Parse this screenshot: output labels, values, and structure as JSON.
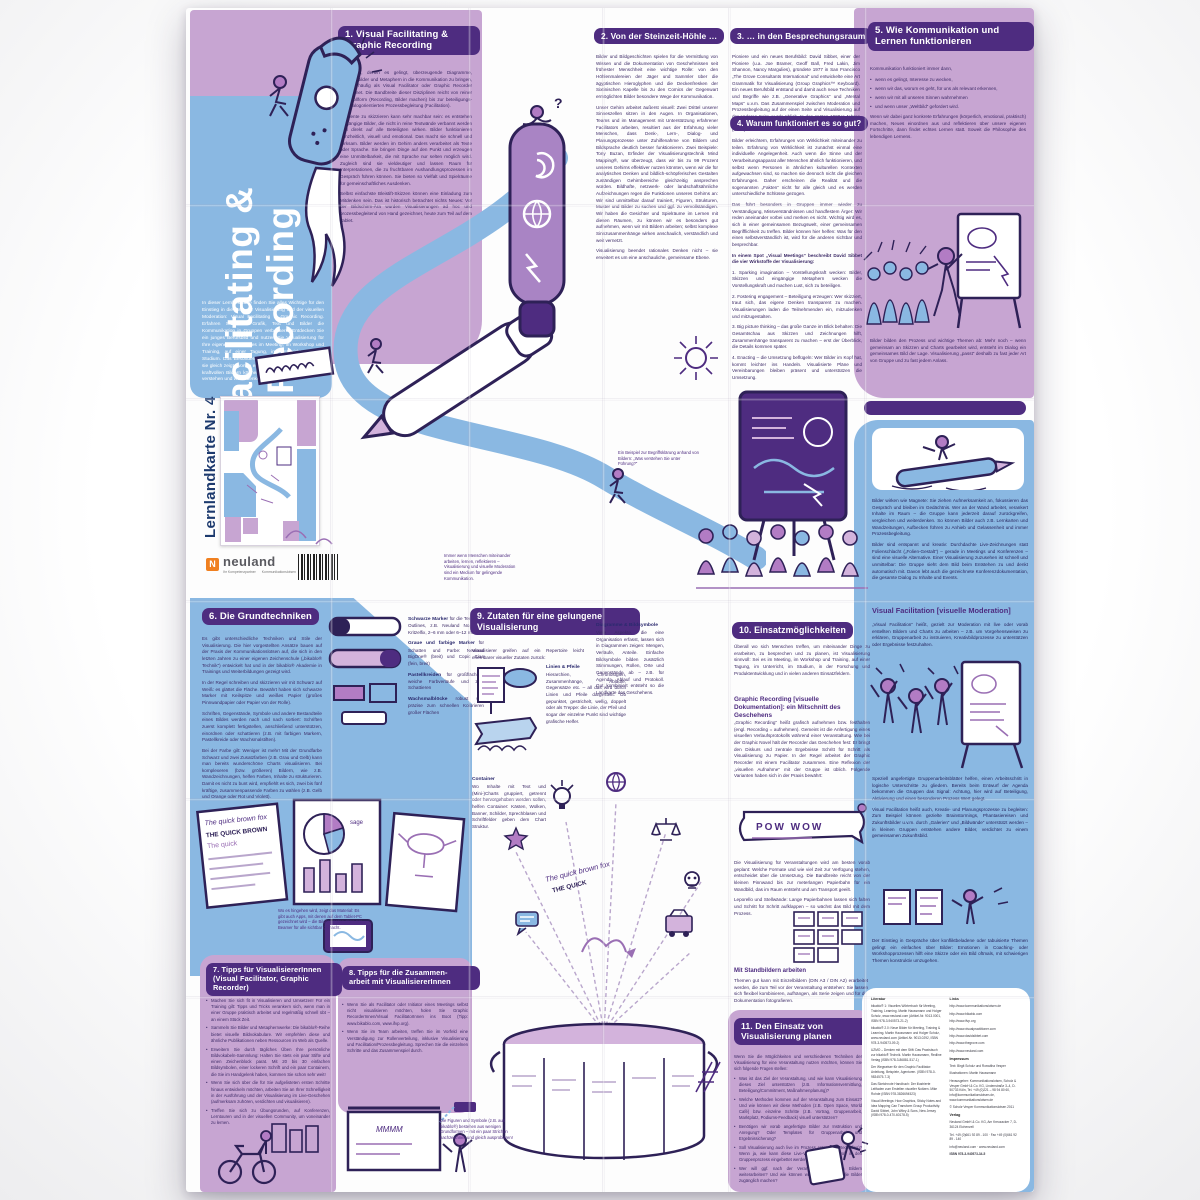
{
  "masthead": {
    "series": "Lernlandkarte Nr. 4",
    "title_line1": "Visual Facilitating &",
    "title_line2": "Graphic Recording",
    "intro": "In dieser Lernlandkarte finden Sie alles Wichtige für den Einstieg in die Welt der Visualisierung und der visuellen Moderation: Visual Facilitating & Graphic Recording. Erfahren Sie, wie Grafik, Text und Bilder die Kommunikation in Gruppen verbessern. Entdecken Sie ein junges Berufsbild und nutzen Sie Visualisierung für Ihre eigene Arbeit: sei es im Meeting, im Workshop und Training, auf einer Tagung, im Unterricht oder im Studium. Das Besondere dieser Lernlandkarte ist, dass sie gleich zeigt, worum es geht: Mit wenigen Worten und kraftvollen Bildern können Sie Inhalte schnell erfassen, verstehen und weiterdenken."
  },
  "captions": {
    "begriff": "Ein Beispiel zur Begriffsklärung anhand von Bildern: „Was verstehen Sie unter Führung?“",
    "medium": "Immer wenn Menschen miteinander arbeiten, lernen, reflektieren – Visualisierung und visuelle Moderation sind ein Medium für gelingende Kommunikation.",
    "figuren": "Die Figuren und Symbole (z.B. aus bikablo®) bestehen aus wenigen Grundformen – mit ein paar Strichen nachzeichnen und gleich ausprobieren!"
  },
  "s1": {
    "h1": "1. Visual Facilitating &",
    "h2": "Graphic Recording",
    "p": [
      "Menschen, denen es gelingt, überzeugende Diagramme, Farben, Bilder und Metaphern in die Kommunikation zu bringen, werden häufig als Visual Facilitator oder Graphic Recorder bezeichnet. Die Bandbreite dieser Disziplinen reicht von reiner Protokollform (Recording, Bilder machen) bis zur beteiligungs- und dialogorientierten Prozessbegleitung (Facilitation).",
      "Elemente zu skizzieren kann sehr machbar sein: es entstehen eingängige Bilder, die nicht in reine Textwände verbannt werden und direkt auf alle Beteiligten wirken. Bilder funktionieren ganzheitlich, visuell und emotional. Das macht sie schnell und wirksam. Bilder werden im Gehirn anders verarbeitet als Texte oder Sprache. Sie bringen Dinge auf den Punkt und erzeugen eine Unmittelbarkeit, die mit Sprache nur selten möglich wird. Zugleich sind sie vieldeutiger und lassen Raum für Interpretationen, die zu fruchtbaren Aushandlungsprozessen im Gespräch führen können. Sie bieten so Vielfalt und Spielräume für gemeinschaftliches Ausdenken.",
      "Selbst einfachste Bleistift-Skizzen können eine Einladung zum Mitdenken sein. Das ist historisch betrachtet nichts Neues: Vor der Bildschirm-Ära wurden Visualisierungen ad hoc und prozessbegleitend von Hand gezeichnet, heute zum Teil auf dem Tablet."
    ]
  },
  "s2": {
    "h": "2. Von der Steinzeit-Höhle …",
    "p": [
      "Bilder und Bildgeschichten spielen für die Vermittlung von Wissen und die Dokumentation von Geschehnissen seit frühester Menschheit eine wichtige Rolle: von den Höhlenmalereien der Jäger und Sammler über die ägyptischen Hieroglyphen und die Deckenfresken der Sixtinischen Kapelle bis zu den Comics der Gegenwart ermöglichten Bilder besondere Wege der Kommunikation.",
      "Unser Gehirn arbeitet äußerst visuell: Zwei Drittel unserer Sinneszellen sitzen in den Augen. In Organisationen, Teams und im Management mit Unterstützung erfahrener Facilitators arbeiten, resultiert aus der Erfahrung vieler Menschen, dass Denk-, Lern-, Dialog- und Planungsprozesse unter Zuhilfenahme von Bildern und Bildsprache deutlich besser funktionieren. Zwei Beispiele: Tony Buzan, Erfinder der Visualisierungstechnik Mind Mapping®, war überzeugt, dass wir bis zu 99 Prozent unseres Gehirns effektiver nutzen könnten, wenn wir die für analytisches Denken und bildlich-schöpferisches Gestalten zuständigen Gehirnbereiche gleichzeitig ansprechen würden. Bildhafte, netzwerk- oder landschaftsähnliche Aufzeichnungen regen die Funktionen unseres Gehirns an: Wir sind unmittelbar darauf trainiert, Figuren, Strukturen, Muster und Bilder zu suchen und ggf. zu vervollständigen. Wir haben die Gesichter und Spielräume im Lernen mit diesen Räumen, zu können wir es besonders gut aufnehmen, wenn wir mit Bildern arbeiten; selbst komplexe Sinnzusammenhänge wirken anschaulich, verständlich und weit vernetzt.",
      "Visualisierung beendet rationales Denken nicht – sie erweitert es um eine anschauliche, gemeinsame Ebene."
    ]
  },
  "s3": {
    "h": "3. … in den Besprechungsraum",
    "p": [
      "Pioniere und ein neues Berufsbild: David Sibbet, einer der Pioniere (u.a. Joe Bramer, Geoff Ball, Fred Lakin, Jim Shannon, Nancy Margulies), gründete 1977 in San Francisco „The Grove Consultants International“ und entwickelte eine Art Grammatik für Visualisierung (Group Graphics™ Keyboard). Ein neues Berufsbild entstand und damit auch neue Techniken und Begriffe wie z.B. „Generative Graphics“ und „Mental Maps“ u.v.m. Das Zusammenspiel zwischen Moderation und Prozessbegleitung auf der einen Seite und Visualisierung auf der anderen Seite wurde üblich. In den späten 1990er-Jahren gründete sich das „International Forum of Visual Practitioners“ (IFVP)."
    ]
  },
  "s4": {
    "h": "4. Warum funktioniert es so gut?",
    "p1": "Bilder erleichtern, Erfahrungen von Wirklichkeit miteinander zu teilen. Erfahrung von Wirklichkeit ist zunächst einmal eine individuelle Angelegenheit. Auch wenn die Sinne und der Verarbeitungsapparat aller Menschen ähnlich funktionieren, und selbst wenn Personen in ähnlichen kulturellen Kontexten aufgewachsen sind, so machen sie dennoch nicht die gleichen Erfahrungen. Daher erscheinen die Realität und die sogenannten „Fakten“ nicht für alle gleich und es werden unterschiedliche Schlüsse gezogen.",
    "p2": "Das führt besonders in Gruppen immer wieder zu Verständigung, Missverständnissen und handfestem Ärger: Wir reden aneinander vorbei und merken es nicht. Wichtig wird es, sich in einer gemeinsamen Bezugswelt, einer gemeinsamen Begrifflichkeit zu treffen. Bilder können hier helfen: Was für den einen selbstverständlich ist, wird für die anderen sichtbar und besprechbar.",
    "lead": "In einem Spot „Visual Meetings“ beschreibt David Sibbet die vier Wirkstoffe der Visualisierung:",
    "items": [
      "1. Sparking imagination – Vorstellungskraft wecken: Bilder, Skizzen und eingängige Metaphern wecken die Vorstellungskraft und machen Lust, sich zu beteiligen.",
      "2. Fostering engagement – Beteiligung erzeugen: Wer skizziert, traut sich, das eigene Denken transparent zu machen. Visualisierungen laden die Teilnehmenden ein, mitzudenken und mitzugestalten.",
      "3. Big picture thinking – das große Ganze im Blick behalten: Die Gesamtschau aus Skizzen und Zeichnungen hilft, Zusammenhänge transparent zu machen – erst der Überblick, die Details kommen später.",
      "4. Enacting – die Umsetzung beflügeln: Wer Bilder im Kopf hat, kommt leichter ins Handeln. Visualisierte Pläne und Vereinbarungen bleiben präsent und unterstützen die Umsetzung."
    ]
  },
  "s5": {
    "h1": "5. Wie Kommunikation und",
    "h2": "Lernen funktionieren",
    "lead": "Kommunikation funktioniert immer dann,",
    "bullets": [
      "wenn es gelingt, Interesse zu wecken,",
      "wenn wir das, worum es geht, für uns als relevant erkennen,",
      "wenn wir mit all unseren Sinnen wahrnehmen",
      "und wenn unser „Weltbild“ gefordert wird."
    ],
    "p2": "Wenn wir dabei ganz konkrete Erfahrungen (körperlich, emotional, praktisch) machen, Neues einordnen aus und reflektieren über unsere eigenen Fortschritte, dann findet echtes Lernen statt. Soweit die Philosophie des lebendigen Lernens.",
    "p3": "Bilder bilden den Prozess und wichtige Themen ab: Mehr noch – wenn gemeinsam an Skizzen und Charts gearbeitet wird, entsteht im Dialog ein gemeinsames Bild der Lage. Visualisierung „passt“ deshalb zu fast jeder Art von Gruppe und zu fast jedem Anlass.",
    "p4": "Bilder wirken wie Magnete: Sie ziehen Aufmerksamkeit an, fokussieren das Gespräch und bleiben im Gedächtnis. Wer an der Wand arbeitet, verankert Inhalte im Raum – die Gruppe kann jederzeit darauf zurückgreifen, vergleichen und weiterdenken. So können Bilder auch z.B. Lernkarten und Wandzeitungen, Aufbecken führen zu Anhieb und Gelassenheit und immer Prozessbegleitung.",
    "p5": "Bilder sind entspannt und kreativ: Durchdachte Live-Zeichnungen statt Folienschlacht („Folien-Gestalt“) – gerade in Meetings und Konferenzen – sind eine visuelle Alternative. Einer Visualisierung zuzusehen ist schnell und unmittelbar: Die Gruppe sieht dem Bild beim Entstehen zu und denkt automatisch mit. Davon lebt auch die gezeichnete Konferenz­dokumentation, die gesamte Dialog zu Inhalte und Events."
  },
  "vf": {
    "h": "Visual Facilitation [visuelle Moderation]",
    "p1": "„Visual Facilitation“ heißt, gezielt zur Moderation mit live oder vorab erstellten Bildern und Charts zu arbeiten – z.B. um Vorgehensweisen zu erklären, Gruppenarbeit zu instruieren, Kreativbildprozesse zu unterstützen oder Ergebnisse festzuhalten.",
    "p2": "Speziell angefertigte Gruppenarbeitsblätter helfen, einen Arbeitsschritt in logische Unterschritte zu gliedern. Bereits beim Entwurf der Agenda bekommen die Gruppen das Signal: Achtung, hier wird auf Beteiligung, Aktivierung und einen besonderen Prozess Wert gelegt.",
    "p3": "Visual Facilitation heißt auch, Kreativ- und Planungsprozesse zu begleiten: Zum Beispiel können gezielte Brainstormings, Phantasiereisen und Zukunftsbilder u.v.m. durch „Galerien“ und „Bildwände“ unterstützt werden – in kleinen Gruppen entstehen andere Bilder, verdichtet zu einem gemeinsamen Zukunftsbild.",
    "p4": "Der Einstieg in Gespräche über konfliktbeladene oder tabuisierte Themen gelingt ein einfaches über Bilder: Emotionen in Coaching- oder Workshopprozessen hilft eine Skizze oder ein Bild oftmals, mit schwierigen Themen konstruktiv umzugehen."
  },
  "s6": {
    "h": "6. Die Grundtechniken",
    "p": [
      "Es gibt unterschiedliche Techniken und Stile der Visualisierung. Die hier vorgestellten Ansätze bauen auf der Praxis der Kommunikationslotsen auf, die sich in den letzten Jahren zu einer eigenen Zeichenschule („bikablo® Technik“) entwickelt hat und in der bikablo® Akademie in Trainings und Weiterbildungen gezeigt wird.",
      "In der Regel schreiben und skizzieren wir mit Schwarz auf Weiß: es glättet die Fläche. Bewährt haben sich schwarze Marker mit Keilspitze und weißes Papier (großes Pinnwandpapier oder Papier von der Rolle).",
      "Schriften, Gegenstände, Symbole und andere Bestandteile eines Bildes werden nach und nach sortiert: Schriften zuerst komplett fertigstellen, anschließend unterstützen, einordnen oder schattieren (z.B. mit farbigen Markern, Pastellkreide oder Wachsmalstiften).",
      "Bei der Farbe gilt: Weniger ist mehr! Mit der Grundfarbe Schwarz und zwei Zusatzfarben (z.B. Grau und Gelb) kann man bereits wunderschöne Charts visualisieren. Bei komplexeren (bzw. größeren) Bildern, wie z.B. Wandzeichnungen, helfen Farben, Inhalte zu strukturieren. Damit es nicht zu bunt wird, empfiehlt es sich, zwei bis fünf kräftige, zusammenpassende Farben zu wählen (z.B. Gelb und Orange oder Rot und Violett)."
    ],
    "supplies": [
      {
        "label": "Schwarze Marker",
        "desc": "für die Texte und Outlines, z.B. Neuland No.One®, Kritzelfix, 2–6 mm oder 6–12 mm"
      },
      {
        "label": "Graue und farbige Marker",
        "desc": "für Schatten und Farbe: Neuland BigOne® (breit) und Copic Ciao (fein, breit)"
      },
      {
        "label": "Pastellkreiden",
        "desc": "für großflächige, weiche Farbverläufe und zum Schattieren"
      },
      {
        "label": "Wachsmalblöcke",
        "desc": "robust und präzise zum schnellen Kolorieren großer Flächen"
      }
    ],
    "caption": "Wo es hingehen wird, zeigt das Material: Es gibt auch Apps, mit denen auf dem Tablet-PC gezeichnet wird – die Bilder werden dann per Beamer für alle sichtbar gemacht.",
    "practice1": "The quick brown fox",
    "practice2": "THE QUICK BROWN FOX"
  },
  "s7": {
    "h": "7. Tipps für VisualisiererInnen",
    "sub": "(Visual Facilitator, Graphic Recorder)",
    "bullets": [
      "Machen Sie sich fit in Visualisieren und Umsetzen! Für ein Training gilt: Tipps und Tricks verankern sich, wenn man in einer Gruppe praktisch arbeitet und regelmäßig schnell übt – an einem Stück Zeit.",
      "Sammeln Sie Bilder und Metaphernwerke: Die bikablo®-Reihe bietet visuelle Bildvokabulare. Wir empfehlen diese und ähnliche Publikationen neben Ressourcen im Web als Quelle.",
      "Erweitern Sie durch tägliches Üben Ihre persönliche Bildvokabeln-Sammlung: Halten Sie stets ein paar Stifte und einen Zeichenblock parat. Mit 20 bis 30 einfachen Bildsymbolen, einer lockeren Schrift und ein paar Containern, die Sie im Handgelenk haben, kommen Sie schon sehr weit!",
      "Wenn Sie sich über die für Sie aufgelisteten ersten Schritte hinaus entwickeln möchten, arbeiten Sie an Ihrer Schnelligkeit in der Ausführung und der Visualisierung im Live-Geschehen (aufmerksam zuhören, verdichten und visualisieren).",
      "Treffen Sie sich zu Übungsrunden, auf Konferenzen, Lerntouren und in der visuellen Community, um voneinander zu lernen."
    ]
  },
  "s8": {
    "h1": "8. Tipps für die Zusammen-",
    "h2": "arbeit mit VisualisiererInnen",
    "bullets": [
      "Wenn Sie als Facilitator oder Initiator eines Meetings selbst nicht visualisieren möchten, holen Sie Graphic RecorderInnen/Visual FacilitatorInnen ins Boot (Tipp: www.bikablo.com, www.ifvp.org).",
      "Wenn Sie im Team arbeiten, treffen Sie im Vorfeld eine Verständigung zur Rollenverteilung, inklusive Visualisierung und Facilitation/Prozessbegleitung. Sprechen Sie die einzelnen Schritte und das Zusammenspiel durch."
    ]
  },
  "s9": {
    "h1": "9. Zutaten für eine gelungene",
    "h2": "Visualisierung",
    "intro": "Visualisierer greifen auf ein Repertoire leicht erlernbarer visueller Zutaten zurück:",
    "items": [
      {
        "label": "Linien & Pfeile",
        "desc": "Hierarchien, Chronologien, Zusammenhänge, Abläufe, Gegensätze etc. – all das wird durch Linien und Pfeile dargestellt. Ob gepunktet, gestrichelt, wellig, doppelt oder als Treppe: die Linie, der Pfeil und sogar der einzelne Punkt sind wichtige grafische Helfer."
      },
      {
        "label": "Container",
        "desc": "Wo Inhalte mit Text und (Mini-)Charts gruppiert, getrennt oder hervorgehoben werden sollen, helfen Container: Kästen, Wolken, Banner, Schilder, Sprechblasen und Schriftfelder geben dem Chart Struktur."
      },
      {
        "label": "Diagramme & Bildsymbole",
        "desc": "Viele Aspekte, die eine Organisation erfasst, lassen sich in Diagrammen zeigen: Mengen, Verläufe, Anteile. Einfache Bildsymbole bilden zusätzlich Stimmungen, Rollen, Orte und Gegenstände ab – z.B. für Agenda, Ablauf und Protokoll. Gut kombiniert entsteht so die Landkarte des Geschehens."
      }
    ]
  },
  "s10": {
    "h": "10. Einsatzmöglichkeiten",
    "p1": "Überall wo sich Menschen treffen, um miteinander Dinge zu erarbeiten, zu besprechen und zu planen, ist Visualisierung sinnvoll: Sei es im Meeting, im Workshop und Training, auf einer Tagung, im Unterricht, im Studium, in der Forschung und Produktentwicklung und in vielen anderen Einsatzfeldern.",
    "sub1": "Graphic Recording [visuelle Dokumentation]: ein Mitschnitt des Geschehens",
    "p2": "„Graphic Recording“ heißt grafisch aufnehmen bzw. festhalten (engl. Recording = aufnehmen). Gemeint ist die Anfertigung eines visuellen Verlaufsprotokolls während einer Veranstaltung. Wie bei der Graphic Novel hält der Recorder das Geschehen fest: Er bringt den Diskurs und zentrale Ergebnisse Schritt für Schritt als Visualisierung zu Papier. In der Regel arbeitet der Graphic Recorder mit einem Facilitator zusammen. Eine Reflexion der „visuellen Aufnahme“ mit der Gruppe ist üblich. Folgende Varianten haben sich in der Praxis bewährt:",
    "p3": "Die Visualisierung für Veranstaltungen wird am besten vorab geplant: Welche Formate und wie viel Zeit zur Verfügung stehen, entscheidet über die Umsetzung. Die Bandbreite reicht von der kleinen Pinnwand bis zur meterlangen Papierbahn für ein Wandbild, das im Raum entsteht und am Transport geeilt.",
    "sub2": "Mit Standbildern arbeiten",
    "p4": "Themen gut kann mit Einzelbildern (DIN A3 / DIN A2) erarbeitet werden, die zum Teil vor der Veranstaltung entstehen: Sie lassen sich flexibel kombinieren, aufhängen, als Serie zeigen und für die Dokumentation fotografieren.",
    "caption": "Leporello und Stellwände: Lange Papierbahnen lassen sich falten und Schritt für Schritt aufklappen – so wächst das Bild mit dem Prozess."
  },
  "s11": {
    "h1": "11. Den Einsatz von",
    "h2": "Visualisierung planen",
    "intro": "Wenn Sie die Möglichkeiten und verschiedenen Techniken der Visualisierung für eine Veranstaltung nutzen möchten, können Sie sich folgende Fragen stellen:",
    "bullets": [
      "Was ist das Ziel der Veranstaltung, und wie kann Visualisierung dieses Ziel unterstützen (z.B. Informationsvermittlung, Beteiligung/Commitment, Maßnahmenplanung)?",
      "Welche Methoden kommen auf der Veranstaltung zum Einsatz? Und wie können wir diese Methoden (z.B. Open Space, World Café) bzw. einzelne Schritte (z.B. Vortrag, Gruppenarbeit, Marktplatz, Podiums-Feedback) visuell unterstützen?",
      "Benötigen wir vorab angefertigte Bilder zur Instruktion und Anregung? Oder Templates für Gruppenarbeit und Ergebnissicherung?",
      "Soll Visualisierung auch live im Prozess entstehen (Recording)? Wenn ja, wie kann diese Live-Visualisierung sinnvoll in den Gruppenprozess eingebettet werden?",
      "Wer will ggf. nach der Veranstaltung mit den Bildern weiterarbeiten? Und wie können wir den Menschen die Bilder zugänglich machen?"
    ]
  },
  "brand": {
    "logo": "neuland",
    "logo_mark": "N",
    "sub_left": "Ihr Kompetenzpartner",
    "sub_right": "Kommunikationslotsen"
  },
  "impressum": {
    "lit_header": "Literatur",
    "lit": [
      "bikablo® 1: Visuelles Wörterbuch für Meeting, Training, Learning. Martin Haussmann und Holger Scholz, www.neuland.com (Artikel-Nr. 9013.0001, ISBN 978-3-940573-21-2)",
      "bikablo® 2.0: Neue Bilder für Meeting, Training & Learning. Martin Haussmann und Holger Scholz, www.neuland.com (Artikel-Nr. 9013.0292, ISBN 978-3-940573-09-2)",
      "UZMO – Denken mit dem Stift: Das Praxisbuch zur bikablo® Technik. Martin Haussmann, Redline Verlag (ISBN 978-3-86881-517-1)",
      "Der Wegweiser für den Graphic Facilitator: Anleitung, Beispiele, Agenturen. (ISBN 978-0-9834575-7-3)",
      "Das Sketchnote Handbuch: Der illustrierte Leitfaden zum Erstellen visueller Notizen. Mike Rohde (ISBN 978-3826694523)",
      "Visual Meetings: How Graphics, Sticky Notes and Idea Mapping Can Transform Group Productivity. David Sibbet, John Wiley & Sons, New Jersey (ISBN 978-0-470-60178-5)"
    ],
    "links_header": "Links",
    "links": [
      "http://www.kommunikationslotsen.de",
      "http://www.bikablo.com",
      "http://www.ifvp.org",
      "http://www.visualpractitioner.com",
      "http://www.davidsibbet.com",
      "http://www.thegrove.com",
      "http://www.neuland.com"
    ],
    "imp_header": "Impressum",
    "credits": [
      "Text: Birgit Scholz und Roswitha Vesper",
      "Illustrationen: Martin Haussmann",
      "Herausgeber: Kommunikationslotsen, Scholz & Vesper GmbH & Co. KG, Lindenstraße 3–4, D-50733 Köln, Tel. +49 (0)221 – 98 94 80 60, info@kommunikationslotsen.de, www.kommunikationslotsen.de",
      "© Scholz·Vesper Kommunikationslotsen 2011"
    ],
    "verlag_header": "Verlag",
    "verlag": [
      "Neuland GmbH & Co. KG, Am Kreuzacker 7, D-36124 Eichenzell",
      "Tel. +49 (0)661 92 89 - 100 · Fax +49 (0)661 92 89 - 140",
      "info@neuland.com · www.neuland.com"
    ],
    "isbn": "ISBN 978-3-940573-34-5"
  }
}
